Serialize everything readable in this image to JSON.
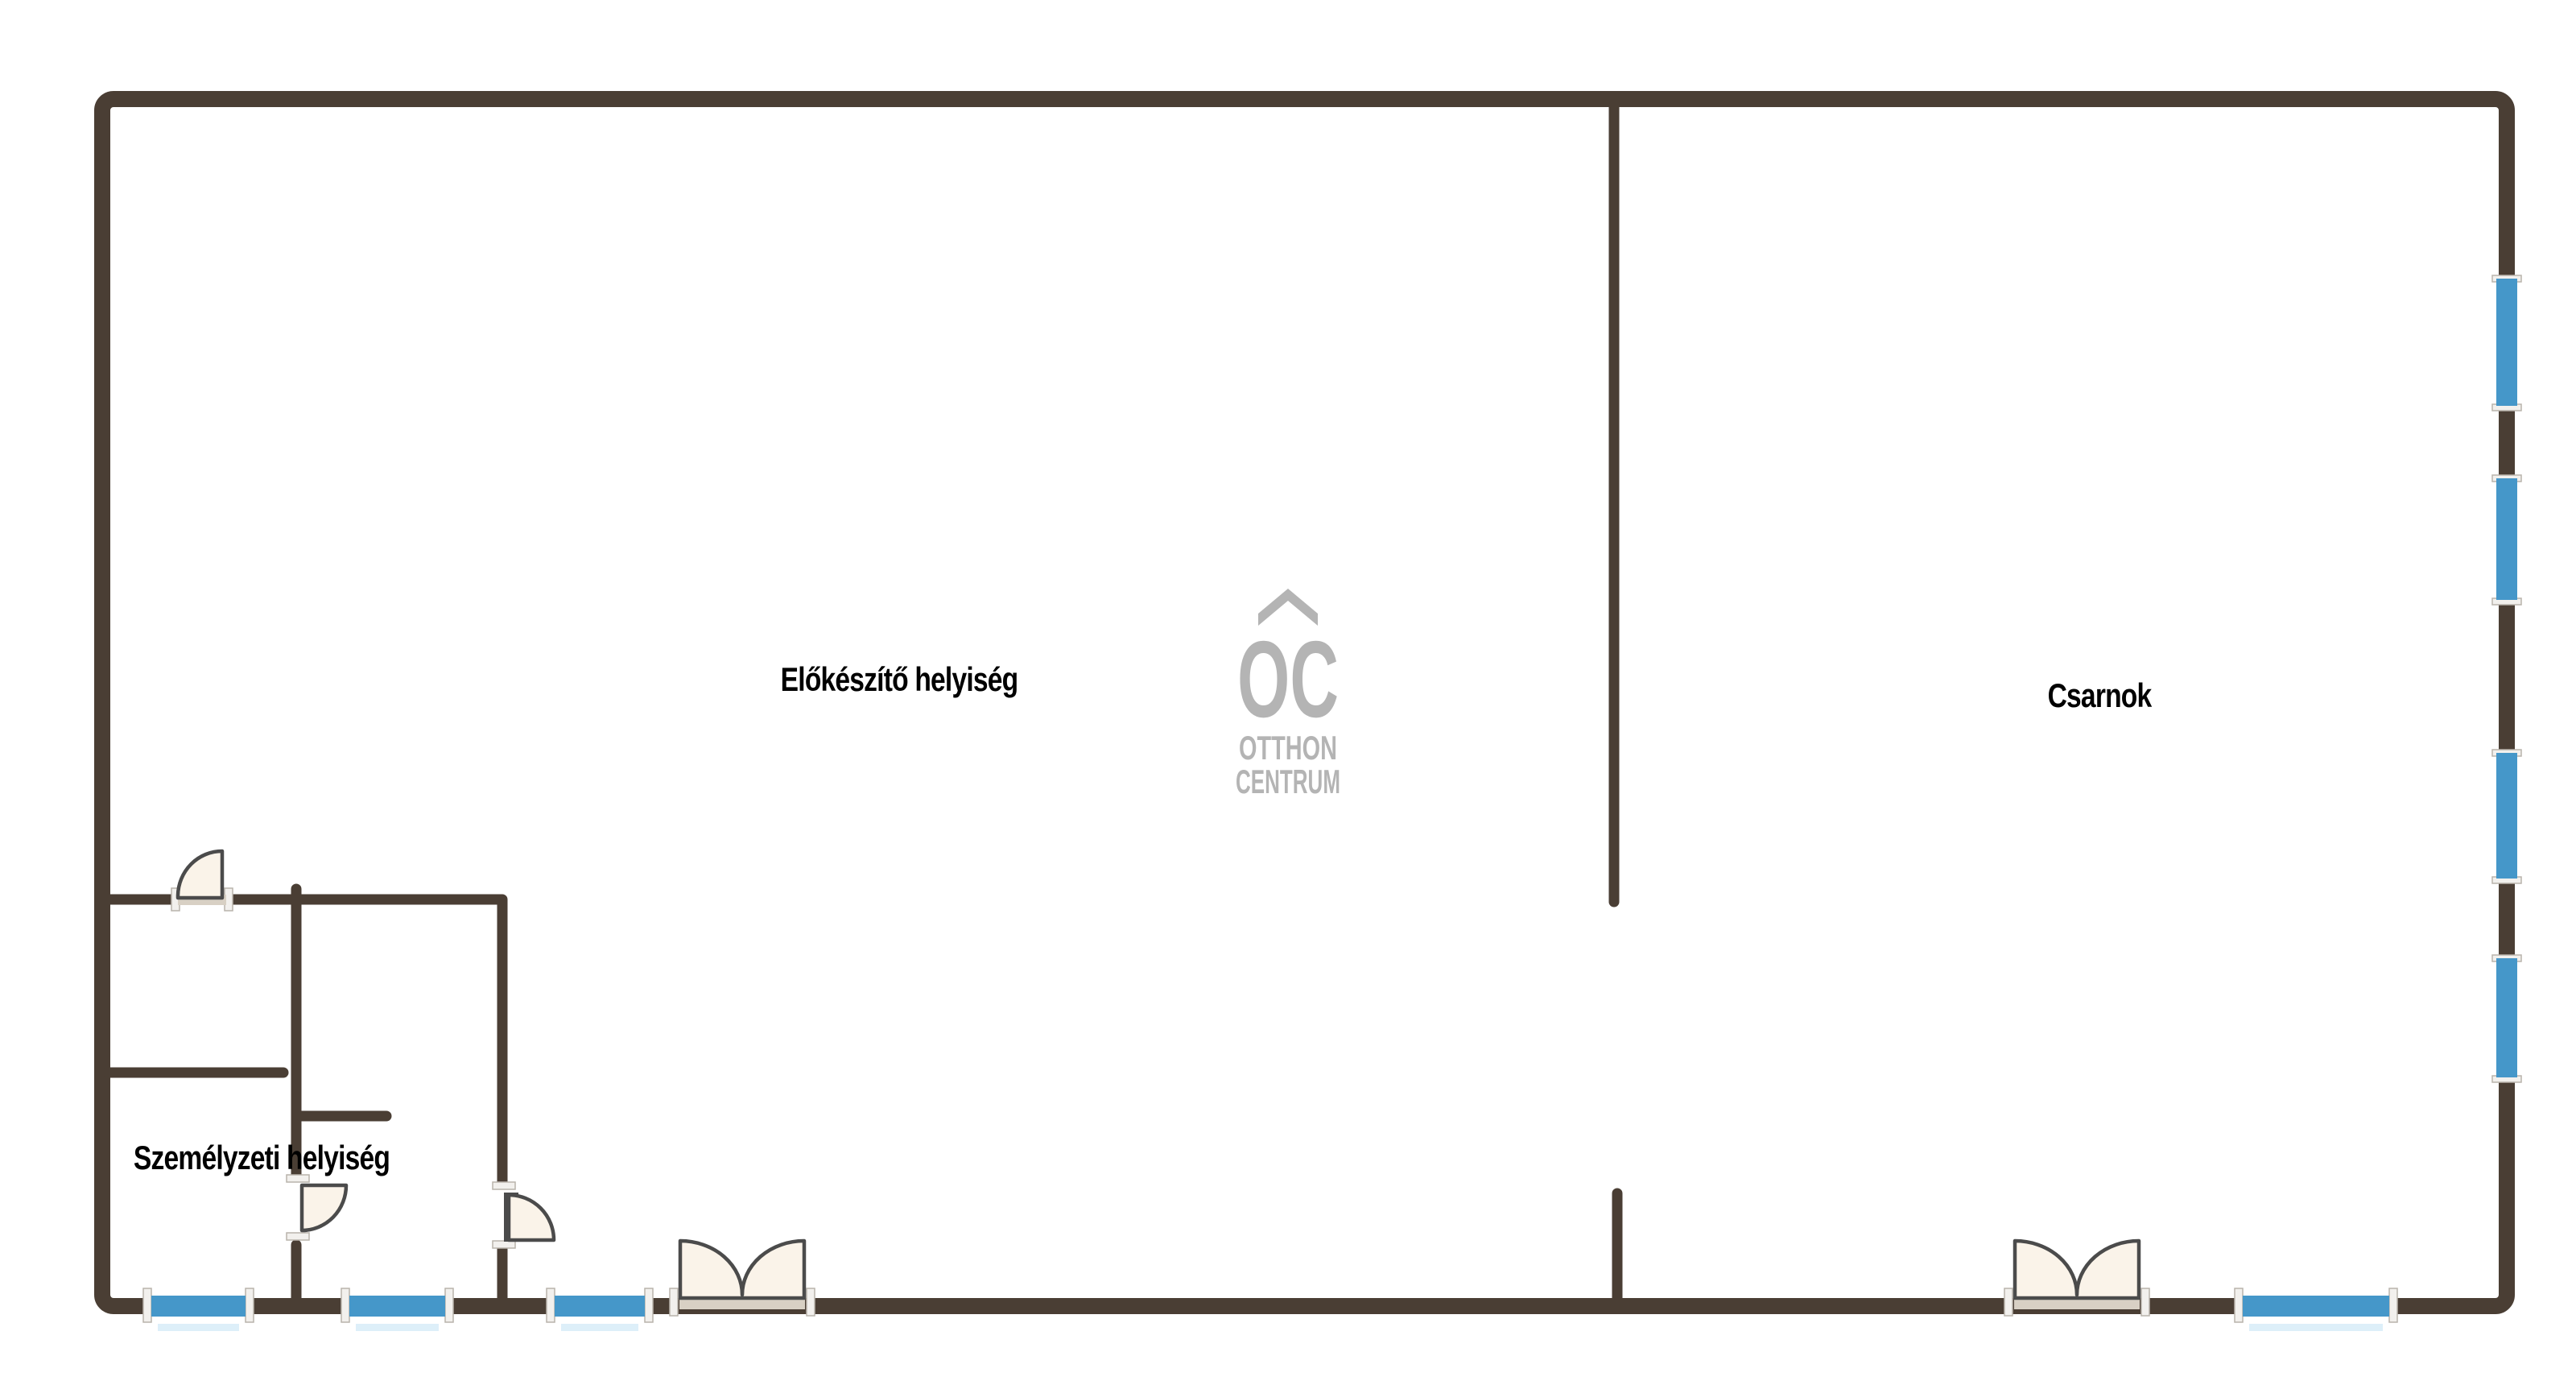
{
  "plan": {
    "rooms": [
      {
        "label": "Előkészítő helyiség"
      },
      {
        "label": "Csarnok"
      },
      {
        "label": "Személyzeti helyiség"
      }
    ],
    "logo": {
      "monogram": "OC",
      "line1": "OTTHON",
      "line2": "CENTRUM"
    }
  },
  "colors": {
    "background": "#ffffff",
    "wall": "#4a3e34",
    "window": "#4597c9",
    "window_shadow": "#cfe8f6",
    "door_fill": "#faf3e9",
    "door_leaf": "#e9e1d4",
    "door_outline": "#4b4b4b",
    "sill": "#d8d0c4",
    "bracket_fill": "#f2f0ed",
    "bracket_stroke": "#b9b4ac",
    "logo_gray": "#b4b4b4",
    "label_text": "#000000"
  }
}
